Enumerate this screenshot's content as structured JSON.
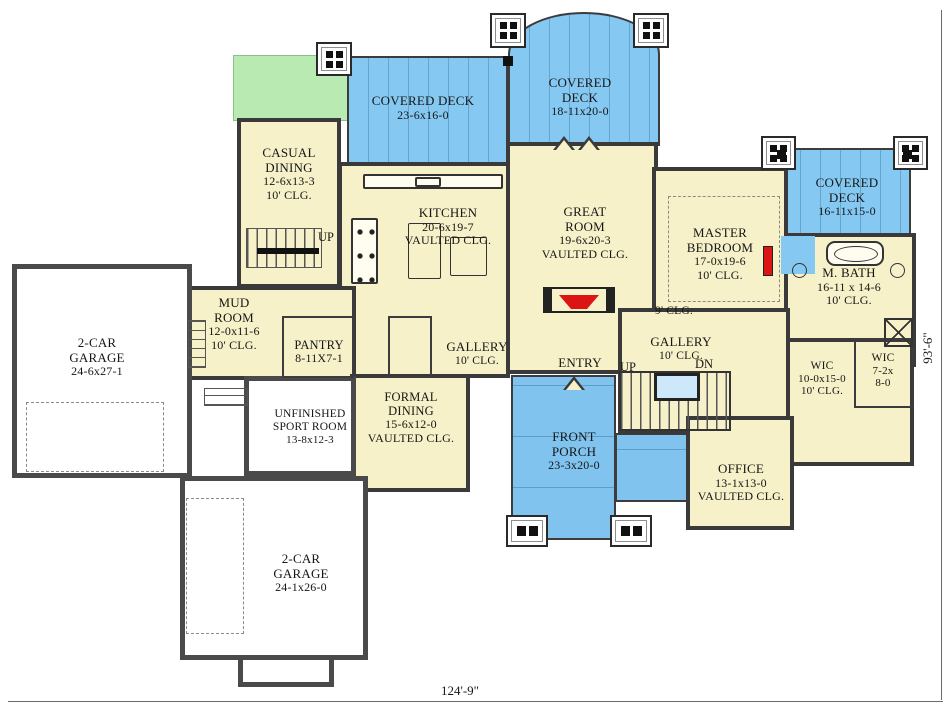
{
  "colors": {
    "deck": "#85c9f2",
    "porch": "#7fc3ee",
    "lawn": "#b9eab2",
    "floor": "#f6f1c8",
    "wall": "#3a3a3a",
    "accent": "#dd1414",
    "stairwell": "#cde8fa"
  },
  "dimensions": {
    "width_label": "124'-9\"",
    "height_label": "93'-6\""
  },
  "labels": {
    "up": "UP",
    "dn": "DN",
    "ceiling_9": "9' CLG."
  },
  "rooms": {
    "covered_deck_left": {
      "name": "COVERED DECK",
      "size": "23-6x16-0"
    },
    "covered_deck_top": {
      "name": "COVERED DECK",
      "size": "18-11x20-0"
    },
    "covered_deck_right": {
      "name": "COVERED DECK",
      "size": "16-11x15-0"
    },
    "casual_dining": {
      "name": "CASUAL DINING",
      "size": "12-6x13-3",
      "ceiling": "10' CLG."
    },
    "kitchen": {
      "name": "KITCHEN",
      "size": "20-6x19-7",
      "ceiling": "VAULTED CLG."
    },
    "great_room": {
      "name": "GREAT ROOM",
      "size": "19-6x20-3",
      "ceiling": "VAULTED CLG."
    },
    "master_bedroom": {
      "name": "MASTER BEDROOM",
      "size": "17-0x19-6",
      "ceiling": "10' CLG."
    },
    "master_bath": {
      "name": "M. BATH",
      "size": "16-11 x 14-6",
      "ceiling": "10' CLG."
    },
    "mud_room": {
      "name": "MUD ROOM",
      "size": "12-0x11-6",
      "ceiling": "10' CLG."
    },
    "pantry": {
      "name": "PANTRY",
      "size": "8-11X7-1"
    },
    "gallery_left": {
      "name": "GALLERY",
      "ceiling": "10' CLG."
    },
    "entry": {
      "name": "ENTRY"
    },
    "gallery_right": {
      "name": "GALLERY",
      "ceiling": "10' CLG."
    },
    "garage_upper": {
      "name": "2-CAR GARAGE",
      "size": "24-6x27-1"
    },
    "sport_room": {
      "name": "UNFINISHED SPORT ROOM",
      "size": "13-8x12-3"
    },
    "formal_dining": {
      "name": "FORMAL DINING",
      "size": "15-6x12-0",
      "ceiling": "VAULTED CLG."
    },
    "front_porch": {
      "name": "FRONT PORCH",
      "size": "23-3x20-0"
    },
    "office": {
      "name": "OFFICE",
      "size": "13-1x13-0",
      "ceiling": "VAULTED CLG."
    },
    "wic_large": {
      "name": "WIC",
      "size": "10-0x15-0",
      "ceiling": "10' CLG."
    },
    "wic_small": {
      "name": "WIC",
      "size": "7-2x 8-0"
    },
    "garage_lower": {
      "name": "2-CAR GARAGE",
      "size": "24-1x26-0"
    }
  }
}
